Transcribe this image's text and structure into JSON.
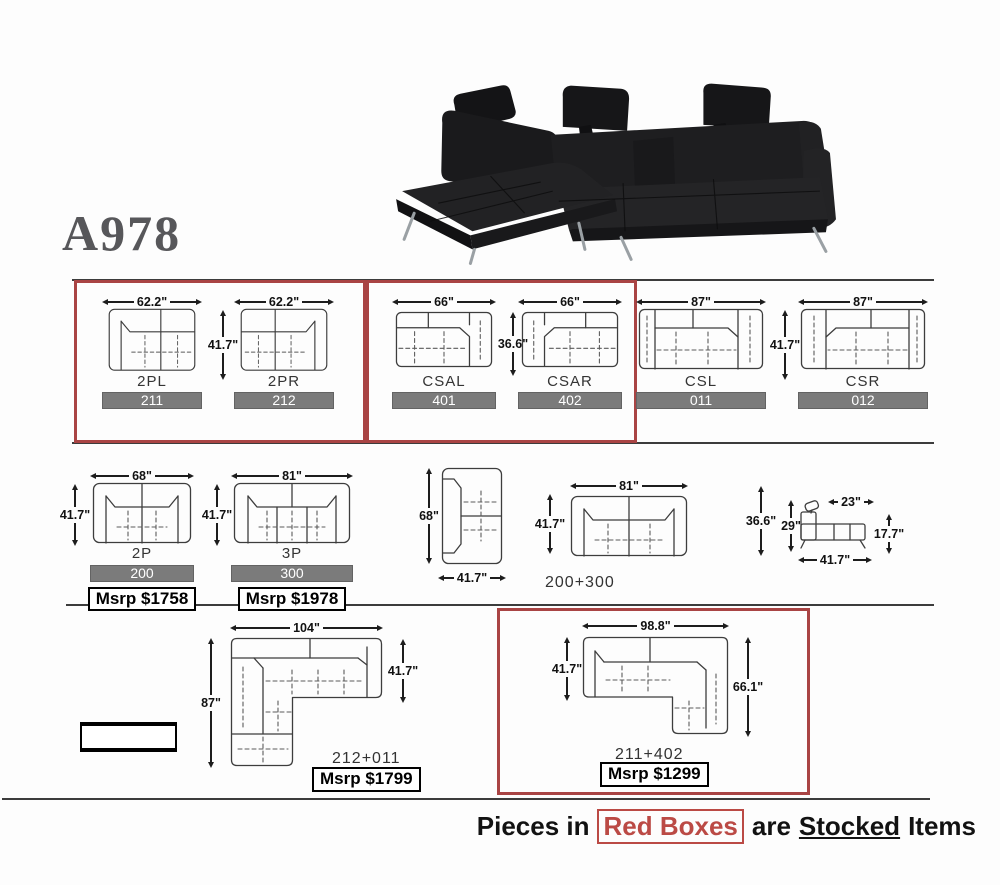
{
  "title": "A978",
  "row1": {
    "g1": {
      "height": "41.7\"",
      "p1": {
        "name": "2PL",
        "code": "211",
        "width": "62.2\""
      },
      "p2": {
        "name": "2PR",
        "code": "212",
        "width": "62.2\""
      }
    },
    "g2": {
      "height": "36.6\"",
      "p1": {
        "name": "CSAL",
        "code": "401",
        "width": "66\""
      },
      "p2": {
        "name": "CSAR",
        "code": "402",
        "width": "66\""
      }
    },
    "g3": {
      "height": "41.7\"",
      "p1": {
        "name": "CSL",
        "code": "011",
        "width": "87\""
      },
      "p2": {
        "name": "CSR",
        "code": "012",
        "width": "87\""
      }
    }
  },
  "row2": {
    "p2seat": {
      "name": "2P",
      "code": "200",
      "width": "68\"",
      "height": "41.7\"",
      "msrp": "Msrp $1758"
    },
    "p3seat": {
      "name": "3P",
      "code": "300",
      "width": "81\"",
      "height": "41.7\"",
      "msrp": "Msrp $1978"
    },
    "chaise": {
      "height": "68\"",
      "width": "41.7\""
    },
    "combo": {
      "name": "200+300",
      "width": "81\"",
      "height": "41.7\""
    },
    "side": {
      "top": "23\"",
      "outer_height": "36.6\"",
      "back_height": "29\"",
      "seat_height": "17.7\"",
      "depth": "41.7\""
    }
  },
  "row3": {
    "l1": {
      "name": "212+011",
      "width": "104\"",
      "left_height": "87\"",
      "right_height": "41.7\"",
      "msrp": "Msrp $1799"
    },
    "l2": {
      "name": "211+402",
      "width": "98.8\"",
      "left_height": "41.7\"",
      "right_height": "66.1\"",
      "msrp": "Msrp $1299"
    }
  },
  "footer": {
    "prefix": "Pieces in",
    "highlight": "Red Boxes",
    "middle": "are",
    "underlined": "Stocked",
    "suffix": "Items"
  },
  "colors": {
    "stocked_box": "#a94444",
    "code_bar": "#7b7b7b"
  }
}
